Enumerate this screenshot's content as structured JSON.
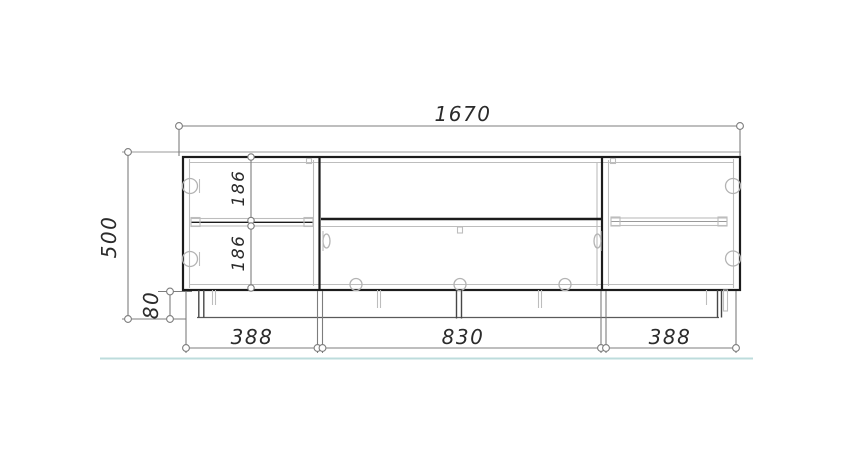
{
  "drawing": {
    "type": "furniture-front-elevation",
    "labels": {
      "overall_width": "1670",
      "overall_height": "500",
      "plinth_height": "80",
      "upper_compartment_height": "186",
      "lower_compartment_height": "186",
      "left_section_width": "388",
      "center_section_width": "830",
      "right_section_width": "388"
    },
    "colors": {
      "outline": "#1c1c1c",
      "dimension_line": "#7d7d7d",
      "detail_line": "#bdbdbd",
      "floor_line": "#bddcdc",
      "text": "#2b2b2b",
      "background": "#ffffff"
    }
  }
}
